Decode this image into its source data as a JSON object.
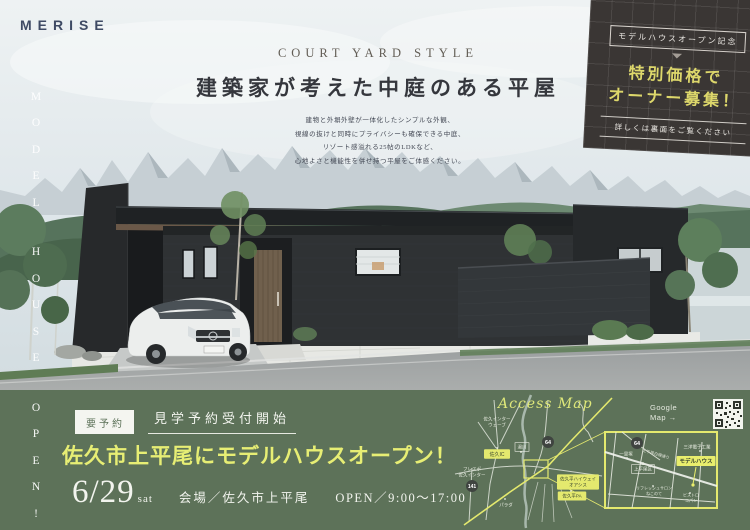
{
  "brand": {
    "logo_text": "MERISE"
  },
  "hero": {
    "eyebrow": "COURT YARD STYLE",
    "title": "建築家が考えた中庭のある平屋",
    "body_lines": [
      "建物と外塀外壁が一体化したシンプルな外観、",
      "視線の抜けと同時にプライバシーも確保できる中庭、",
      "リゾート感溢れる25帖のLDKなど、",
      "心地よさと機能性を併せ持つ平屋をご体感ください。"
    ]
  },
  "promo": {
    "badge": "モデルハウスオープン記念",
    "line1": "特別価格で",
    "line2": "オーナー募集！",
    "note": "詳しくは裏面をご覧ください"
  },
  "vertical_banner": {
    "text": "MODEL HOUSE OPEN!"
  },
  "event": {
    "reserve_badge": "要予約",
    "reserve_note": "見学予約受付開始",
    "headline": "佐久市上平尾にモデルハウスオープン！",
    "date": "6/29",
    "day": "sat",
    "venue": "会場／佐久市上平尾",
    "hours": "OPEN／9:00〜17:00"
  },
  "map": {
    "title": "Access Map",
    "google_line1": "Google",
    "google_line2": "Map →",
    "labels": [
      {
        "k": "text",
        "x": 47,
        "y": 30,
        "fs": 4.5,
        "lines": [
          "佐久インター",
          "ウェーブ"
        ]
      },
      {
        "k": "ybox",
        "x": 47,
        "y": 62,
        "fs": 5,
        "lines": [
          "佐久IC"
        ]
      },
      {
        "k": "wbox",
        "x": 72,
        "y": 55,
        "fs": 4.5,
        "lines": [
          "湯川"
        ]
      },
      {
        "k": "badge",
        "x": 98,
        "y": 50,
        "r": 6,
        "fs": 5.5,
        "lines": [
          "64"
        ]
      },
      {
        "k": "badge",
        "x": 22,
        "y": 94,
        "r": 6,
        "fs": 5,
        "lines": [
          "141"
        ]
      },
      {
        "k": "text",
        "x": 22,
        "y": 80,
        "fs": 4.5,
        "lines": [
          "フレスポ",
          "佐久インター"
        ]
      },
      {
        "k": "ybox",
        "x": 128,
        "y": 90,
        "fs": 4.5,
        "lines": [
          "佐久平ハイウェイ",
          "オアシス"
        ]
      },
      {
        "k": "ybox",
        "x": 122,
        "y": 104,
        "fs": 4.5,
        "lines": [
          "佐久平PA"
        ]
      },
      {
        "k": "text",
        "x": 56,
        "y": 113,
        "fs": 4.5,
        "lines": [
          "パラダ"
        ]
      },
      {
        "k": "badge",
        "x": 187,
        "y": 51,
        "r": 6,
        "fs": 5.5,
        "lines": [
          "64"
        ]
      },
      {
        "k": "text",
        "x": 247,
        "y": 55,
        "fs": 4.5,
        "lines": [
          "三洋電子工業"
        ]
      },
      {
        "k": "model",
        "x": 246,
        "y": 69,
        "fs": 5.5,
        "lines": [
          "モデルハウス"
        ]
      },
      {
        "k": "text",
        "x": 176,
        "y": 62,
        "fs": 4.5,
        "lines": [
          "一里塚"
        ]
      },
      {
        "k": "wbox",
        "x": 193,
        "y": 77,
        "fs": 4.5,
        "lines": [
          "上平尾区"
        ]
      },
      {
        "k": "rtext",
        "x": 206,
        "y": 62,
        "fs": 4,
        "rot": 16,
        "lines": [
          "上平尾白樺通り"
        ]
      },
      {
        "k": "text",
        "x": 204,
        "y": 99,
        "fs": 4,
        "lines": [
          "リフレッシュサロン",
          "ねこのて"
        ]
      },
      {
        "k": "text",
        "x": 241,
        "y": 106,
        "fs": 4,
        "lines": [
          "ビストロ",
          "コパン"
        ]
      }
    ]
  },
  "colors": {
    "band_green": "#5d7259",
    "accent_yellow": "#e7ee74",
    "promo_bg": "#3a3634",
    "promo_yellow": "#ddd76b",
    "logo_navy": "#3e4a64"
  }
}
